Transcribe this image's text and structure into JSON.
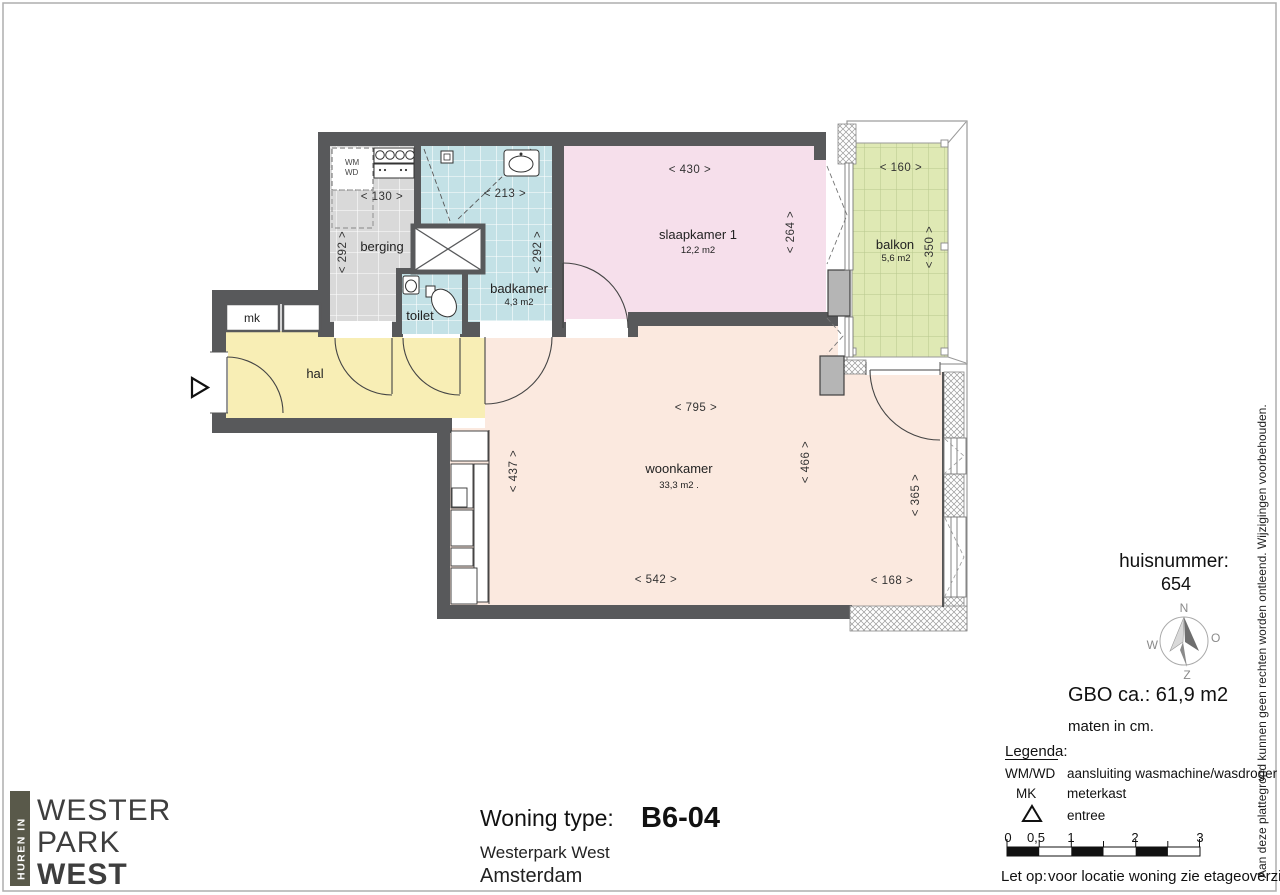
{
  "colors": {
    "wall": "#58595b",
    "berging_floor": "#d9d9d9",
    "badkamer_floor": "#c3e1e6",
    "slaapkamer_floor": "#f6dfeb",
    "woonkamer_floor": "#fbe9df",
    "hal_floor": "#f8eeb5",
    "balkon_floor": "#dfe9b4",
    "pier": "#b5b5b5",
    "logo_bar": "#59594a"
  },
  "plan": {
    "rooms": {
      "hal": {
        "label": "hal"
      },
      "berging": {
        "label": "berging"
      },
      "badkamer": {
        "label": "badkamer",
        "area": "4,3 m2"
      },
      "toilet": {
        "label": "toilet"
      },
      "slaapkamer": {
        "label": "slaapkamer 1",
        "area": "12,2 m2"
      },
      "woonkamer": {
        "label": "woonkamer",
        "area": "33,3 m2 ."
      },
      "balkon": {
        "label": "balkon",
        "area": "5,6 m2"
      },
      "mk": {
        "label": "mk"
      }
    },
    "appliance_wm": "WM",
    "appliance_wd": "WD",
    "dims": {
      "d130": "<  130  >",
      "d213": "<  213  >",
      "d430": "<  430  >",
      "d160": "<  160  >",
      "d795": "<  795  >",
      "d542": "<  542  >",
      "d168": "<  168  >",
      "d292a": "<  292  >",
      "d292b": "<  292  >",
      "d264": "<  264  >",
      "d350": "<  350  >",
      "d437": "<  437  >",
      "d466": "<  466  >",
      "d365": "<  365  >"
    }
  },
  "info": {
    "huisnummer_label": "huisnummer:",
    "huisnummer_value": "654",
    "gbo": "GBO ca.:  61,9 m2",
    "units": "maten in cm.",
    "compass": {
      "n": "N",
      "e": "O",
      "w": "W",
      "s": "Z"
    }
  },
  "legend": {
    "title": "Legenda:",
    "items": [
      {
        "key": "WM/WD",
        "value": "aansluiting wasmachine/wasdroger"
      },
      {
        "key": "MK",
        "value": "meterkast"
      },
      {
        "key": "entree-triangle",
        "value": "entree"
      }
    ],
    "scale": {
      "l0": "0",
      "l05": "0,5",
      "l1": "1",
      "l2": "2",
      "l3": "3"
    },
    "note_label": "Let op:",
    "note": "voor locatie woning zie etageoverzicht."
  },
  "title_block": {
    "label": "Woning type:",
    "value": "B6-04",
    "project": "Westerpark West",
    "city": "Amsterdam"
  },
  "logo": {
    "vertical": "HUREN IN",
    "line1": "WESTER",
    "line2": "PARK",
    "line3": "WEST"
  },
  "disclaimer": "Aan deze plattegrond kunnen geen rechten worden ontleend. Wijzigingen voorbehouden."
}
